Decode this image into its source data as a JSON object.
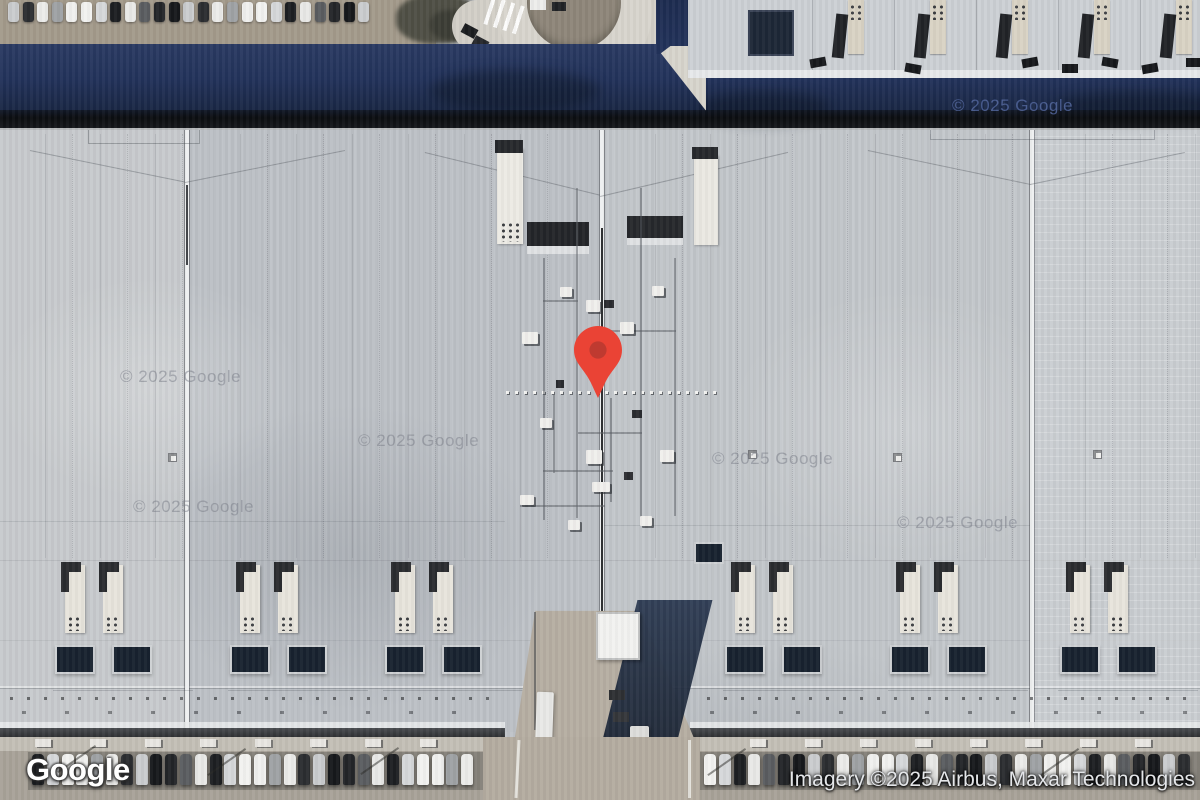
{
  "map": {
    "logo": "Google",
    "attribution": "Imagery ©2025 Airbus, Maxar Technologies",
    "watermark": "© 2025 Google",
    "marker": {
      "color": "#EA4335",
      "inner_color": "#BF3A30"
    },
    "colors": {
      "roof": "#bfc3c8",
      "navy_band": "#22325A",
      "black_shadow_line": "#0B0D10",
      "skylight_navy": "#18222F",
      "pavement": "#A8A298"
    }
  }
}
